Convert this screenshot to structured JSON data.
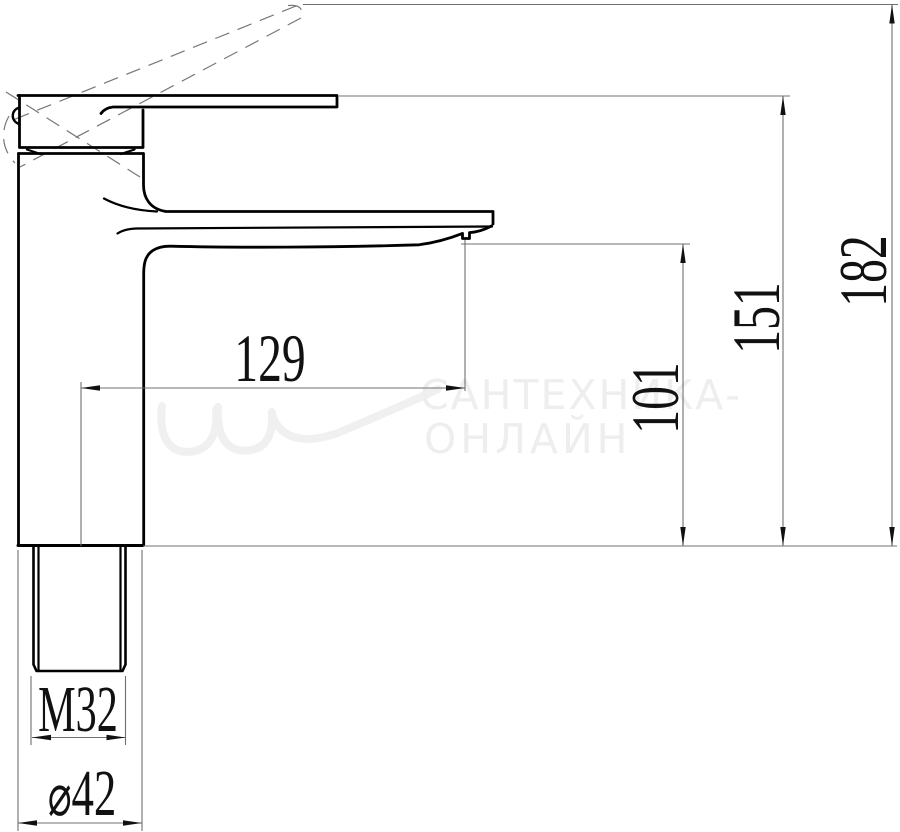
{
  "dimensions": {
    "spout_reach": "129",
    "spout_height": "101",
    "height_to_handle": "151",
    "overall_height": "182",
    "mounting_thread": "M32",
    "base_diameter_symbol": "⌀",
    "base_diameter_value": "42"
  },
  "watermark": {
    "line1": "САНТЕХНИКА-",
    "line2": "ОНЛАЙН"
  },
  "colors": {
    "outline": "#000000",
    "dimension_lines": "#707070",
    "watermark": "#eeeeee"
  }
}
